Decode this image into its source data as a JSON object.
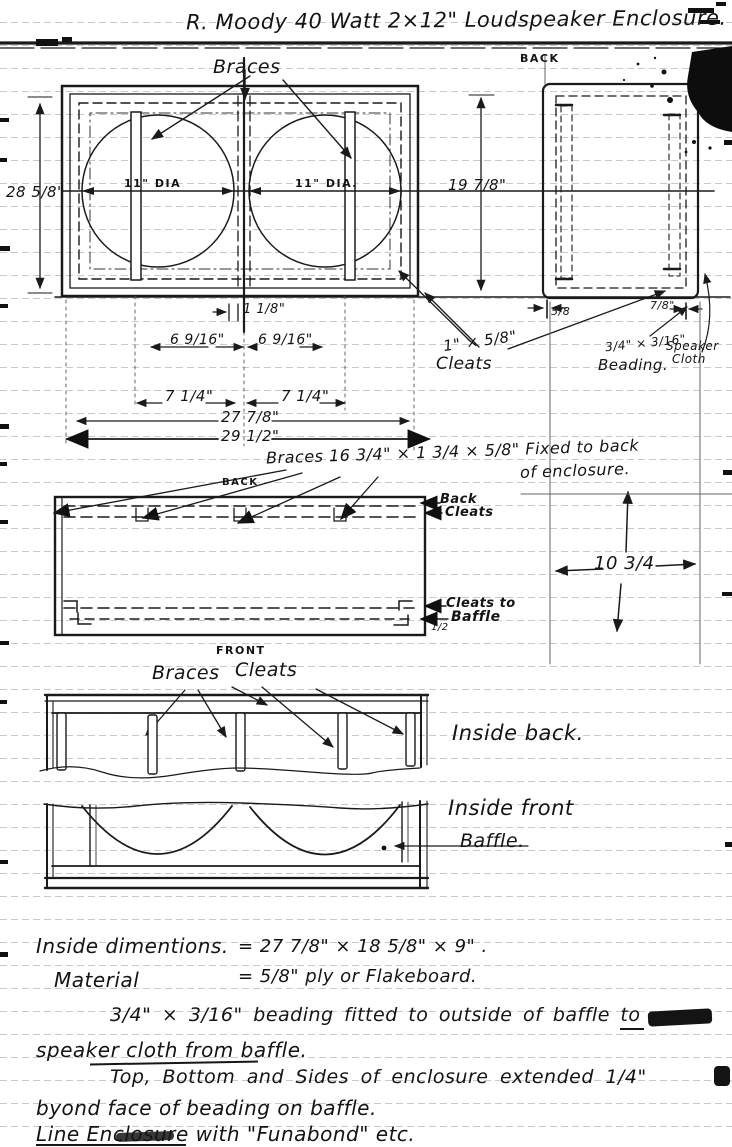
{
  "page": {
    "title": "R. Moody    40 Watt   2×12\"  Loudspeaker Enclosure.",
    "ink": "#1a1a1a",
    "paper": "#ffffff"
  },
  "front_view": {
    "braces_label": "Braces",
    "left_circle_dia": "11\" DIA",
    "right_circle_dia": "11\" DIA.",
    "height_dim": "28 5/8\"",
    "center_gap_dim": "1 1/8\"",
    "spacing_left_dim": "6 9/16\"",
    "spacing_right_dim": "6 9/16\"",
    "half_left_dim": "7 1/4\"",
    "half_right_dim": "7 1/4\"",
    "inner_width_dim": "27 7/8\"",
    "outer_width_dim": "29 1/2\""
  },
  "cleat_labels": {
    "size": "1\" × 5/8\"",
    "word": "Cleats"
  },
  "back_view": {
    "caption": "BACK",
    "height_dim": "19 7/8\"",
    "side_dim": "5/8",
    "edge_dim": "7/8\"",
    "beading_size": "3/4\" × 3/16\"",
    "beading_word": "Beading.",
    "cloth_line1": "Speaker",
    "cloth_line2": "Cloth"
  },
  "plan_view": {
    "braces_note_line1": "Braces 16 3/4\" × 1 3/4 × 5/8\" Fixed to back",
    "braces_note_line2": "of enclosure.",
    "back_label": "BACK",
    "front_label": "FRONT",
    "back_cleats_line1": "Back",
    "back_cleats_line2": "Cleats",
    "cleats_to_label": "Cleats to",
    "baffle_label": "Baffle",
    "half_dim": "1/2",
    "depth_dim": "10 3/4"
  },
  "inside_back": {
    "braces_label": "Braces",
    "cleats_label": "Cleats",
    "caption": "Inside back."
  },
  "inside_front": {
    "caption": "Inside front",
    "baffle_label": "Baffle."
  },
  "notes": {
    "line1_label": "Inside dimentions.",
    "line1_value": "=  27 7/8\" × 18 5/8\" × 9\" .",
    "line2_label": "Material",
    "line2_value": "=  5/8\" ply  or  Flakeboard.",
    "line3": "3/4\" × 3/16\" beading fitted to outside of baffle to",
    "line4": "speaker cloth from baffle.",
    "line5": "Top, Bottom and Sides of enclosure extended 1/4\"",
    "line6": "byond face of beading on baffle.",
    "line7": "Line Enclosure with \"Funabond\" etc."
  }
}
